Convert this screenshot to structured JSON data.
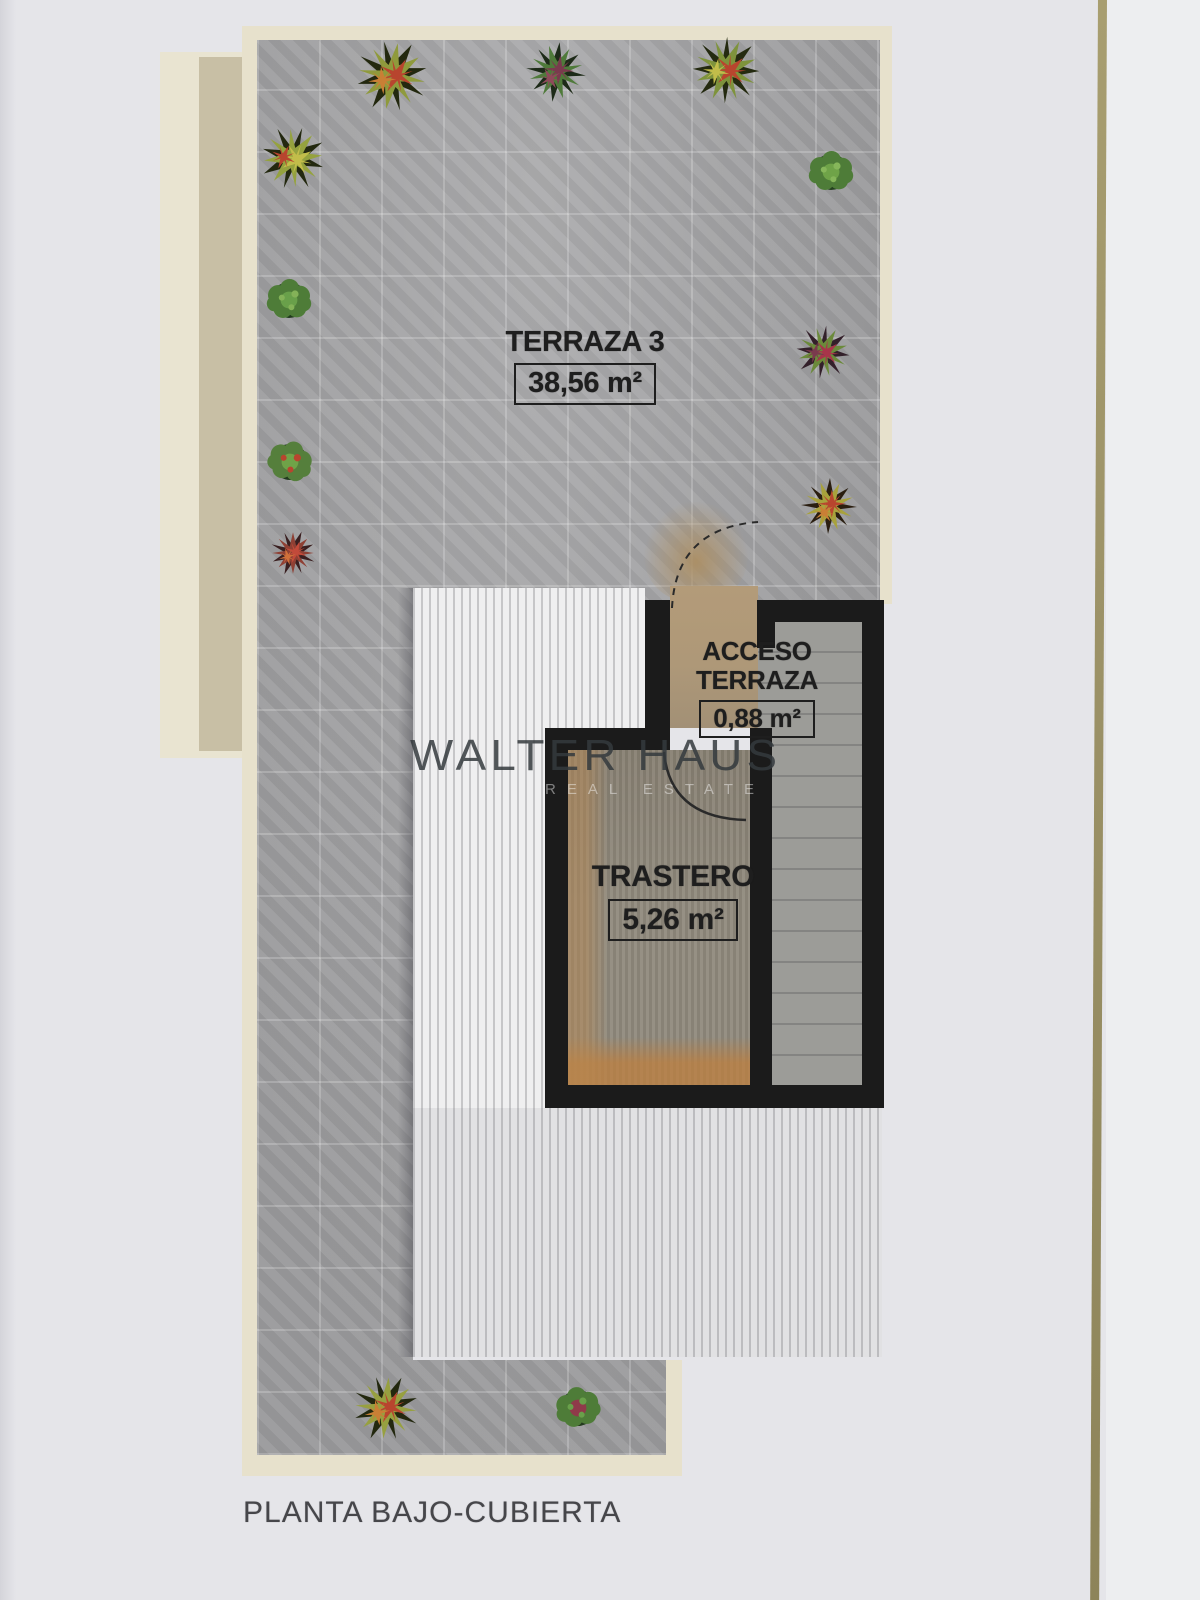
{
  "document": {
    "caption": "PLANTA BAJO-CUBIERTA",
    "watermark": {
      "line1": "WALTER HAUS",
      "line2": "REAL ESTATE"
    },
    "rooms": {
      "terraza3": {
        "name": "TERRAZA 3",
        "area": "38,56 m²"
      },
      "acceso": {
        "name": "ACCESO TERRAZA",
        "area": "0,88 m²"
      },
      "trastero": {
        "name": "TRASTERO",
        "area": "5,26 m²"
      }
    }
  },
  "colors": {
    "paper": "#e5e5e9",
    "paper-right": "#edeef0",
    "gold-line": "#9c9267",
    "cream": "#e7e1cc",
    "tan-strip": "#c8bfa5",
    "tan-strip-light": "#e9e4d1",
    "terrace": "#a4a4a6",
    "deck": "#efeff0",
    "deck-line": "#c6c6c8",
    "stairs": "#9c9c98",
    "wall": "#1b1b1b",
    "access-floor": "#ae9878",
    "trastero-floor": "#8f897c",
    "label-ink": "#1e1e1e",
    "caption-ink": "#46464a",
    "watermark-ink": "#383d40"
  }
}
